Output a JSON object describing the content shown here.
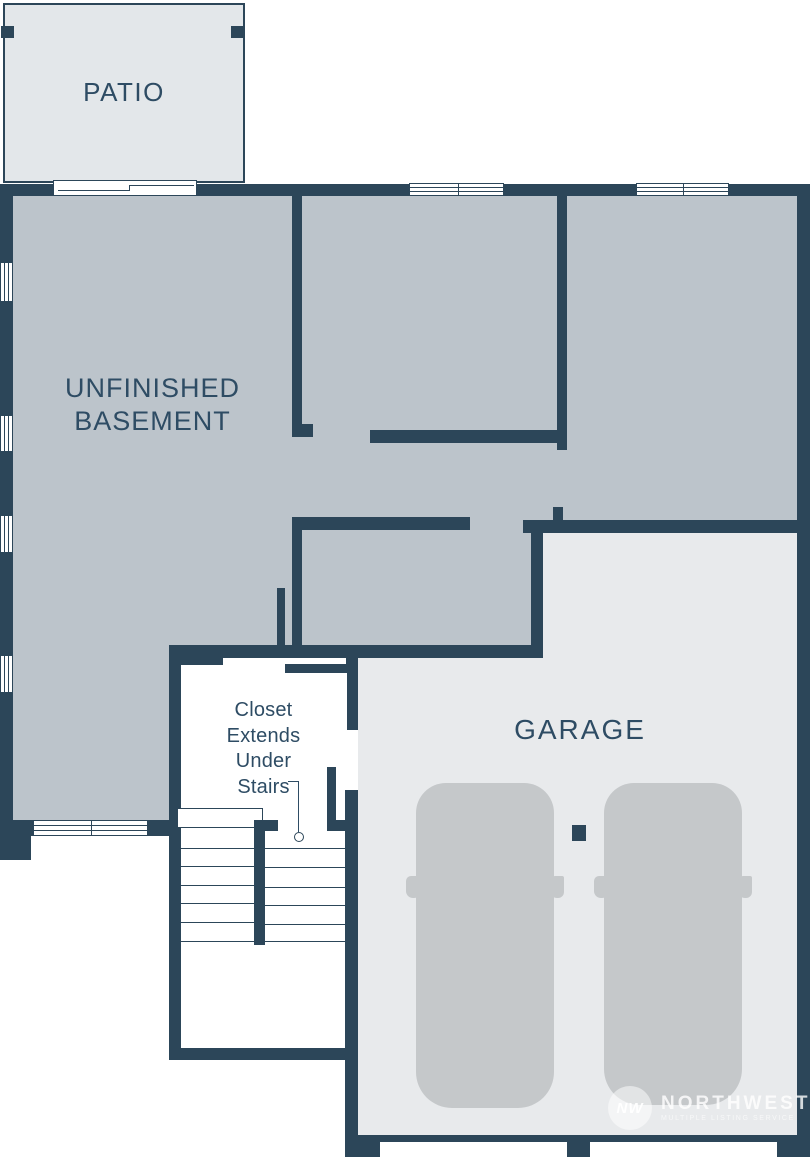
{
  "plan_title": "Basement level floor plan",
  "palette": {
    "wall": "#2c4659",
    "label_text": "#2e4c64",
    "basement_floor": "#bcc4cb",
    "patio_floor": "#e3e7ea",
    "garage_floor": "#e8eaec",
    "closet_floor": "#ffffff",
    "car_silhouette": "#c5c8ca"
  },
  "rooms": {
    "patio": {
      "label": "PATIO"
    },
    "basement": {
      "label": "UNFINISHED BASEMENT",
      "lines": [
        "UNFINISHED",
        "BASEMENT"
      ]
    },
    "garage": {
      "label": "GARAGE",
      "car_count": 2
    },
    "closet": {
      "label": "Closet Extends Under Stairs",
      "lines": [
        "Closet",
        "Extends",
        "Under",
        "Stairs"
      ]
    }
  },
  "features": {
    "stairs": "switchback stairs with closet extending underneath",
    "windows_left_wall": 4,
    "windows_top_wall": 2,
    "window_bottom_wall": 1,
    "sliding_door": "patio to basement"
  },
  "watermark": {
    "monogram": "NW",
    "brand": "NORTHWEST",
    "subtitle": "MULTIPLE LISTING SERVICE"
  }
}
